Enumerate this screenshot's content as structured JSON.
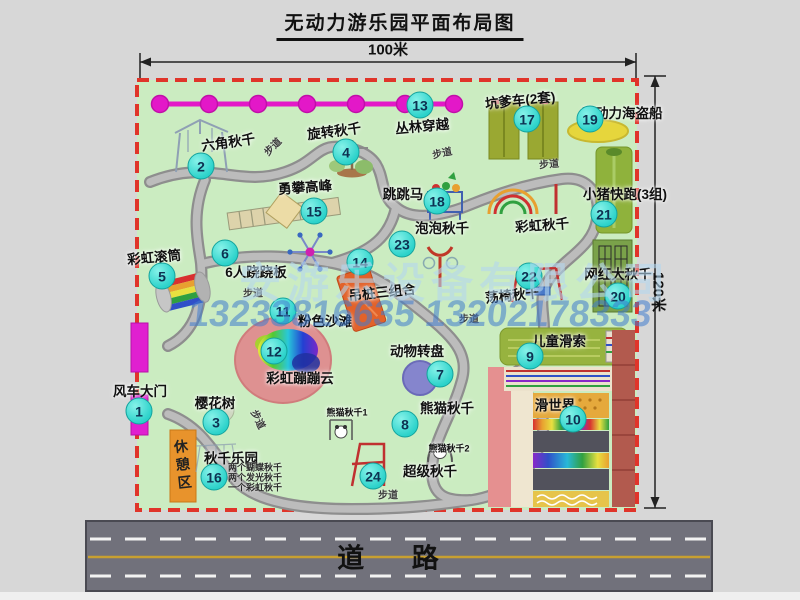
{
  "title": "无动力游乐园平面布局图",
  "dimensions": {
    "width": "100米",
    "height": "120米"
  },
  "road": {
    "label": "道 路"
  },
  "watermark": {
    "company": "安游乐设备有限公司",
    "phones": "13233816635 13202178333"
  },
  "rest_area": {
    "label": "休憩区"
  },
  "colors": {
    "map_green": "#cbecc1",
    "border_red": "#e0342a",
    "badge_cyan": "#2bd2ca",
    "chain_magenta": "#e318c8",
    "gate_magenta": "#e020d0",
    "road_gray": "#71717b",
    "rest_orange": "#e8932c",
    "watermark_blue": "#407cce"
  },
  "map": {
    "walkway_label": "步道",
    "walkway_labels": [
      {
        "x": 272,
        "y": 146,
        "rot": -45
      },
      {
        "x": 442,
        "y": 152,
        "rot": -12
      },
      {
        "x": 549,
        "y": 163,
        "rot": -5
      },
      {
        "x": 253,
        "y": 292,
        "rot": 0
      },
      {
        "x": 469,
        "y": 318,
        "rot": 0
      },
      {
        "x": 259,
        "y": 419,
        "rot": 64
      },
      {
        "x": 388,
        "y": 494,
        "rot": 0
      }
    ],
    "swing_notes": {
      "x": 255,
      "y": 467,
      "items": [
        "两个蝴蝶秋千",
        "两个发光秋千",
        "一个彩虹秋千"
      ]
    },
    "pois": [
      {
        "num": 1,
        "label": "风车大门",
        "lx": 140,
        "ly": 390,
        "bx": 139,
        "by": 411
      },
      {
        "num": 2,
        "label": "六角秋千",
        "lx": 228,
        "ly": 141,
        "rot": -8,
        "bx": 201,
        "by": 166
      },
      {
        "num": 3,
        "label": "樱花树",
        "lx": 215,
        "ly": 402,
        "bx": 216,
        "by": 422
      },
      {
        "num": 4,
        "label": "旋转秋千",
        "lx": 334,
        "ly": 130,
        "rot": -7,
        "bx": 346,
        "by": 152
      },
      {
        "num": 5,
        "label": "彩虹滚筒",
        "lx": 154,
        "ly": 256,
        "rot": -5,
        "bx": 162,
        "by": 276
      },
      {
        "num": 6,
        "label": "6人跷跷板",
        "lx": 256,
        "ly": 271,
        "bx": 225,
        "by": 253
      },
      {
        "num": 7,
        "label": "动物转盘",
        "lx": 417,
        "ly": 350,
        "bx": 440,
        "by": 374
      },
      {
        "num": 8,
        "label": "熊猫秋千",
        "lx": 447,
        "ly": 407,
        "bx": 405,
        "by": 424
      },
      {
        "num": 9,
        "label": "儿童滑索",
        "lx": 559,
        "ly": 340,
        "bx": 530,
        "by": 356
      },
      {
        "num": 10,
        "label": "滑世界",
        "lx": 555,
        "ly": 404,
        "bx": 573,
        "by": 419
      },
      {
        "num": 11,
        "label": "粉色沙滩",
        "lx": 325,
        "ly": 320,
        "bx": 283,
        "by": 311
      },
      {
        "num": 12,
        "label": "彩虹蹦蹦云",
        "lx": 300,
        "ly": 377,
        "bx": 274,
        "by": 351
      },
      {
        "num": 13,
        "label": "丛林穿越",
        "lx": 422,
        "ly": 125,
        "rot": -5,
        "bx": 420,
        "by": 105
      },
      {
        "num": 14,
        "label": "吊桩三组合",
        "lx": 382,
        "ly": 291,
        "rot": -6,
        "bx": 360,
        "by": 262
      },
      {
        "num": 15,
        "label": "勇攀高峰",
        "lx": 305,
        "ly": 186,
        "rot": -4,
        "bx": 314,
        "by": 211
      },
      {
        "num": 16,
        "label": "秋千乐园",
        "lx": 231,
        "ly": 457,
        "bx": 214,
        "by": 477
      },
      {
        "num": 17,
        "label": "坑爹车(2套)",
        "lx": 520,
        "ly": 99,
        "rot": -6,
        "bx": 527,
        "by": 119
      },
      {
        "num": 18,
        "label": "跳跳马",
        "lx": 403,
        "ly": 193,
        "bx": 437,
        "by": 201
      },
      {
        "num": 19,
        "label": "无动力海盗船",
        "lx": 622,
        "ly": 112,
        "bx": 590,
        "by": 119
      },
      {
        "num": 20,
        "label": "网红大秋千",
        "lx": 618,
        "ly": 273,
        "bx": 618,
        "by": 296
      },
      {
        "num": 21,
        "label": "小猪快跑(3组)",
        "lx": 625,
        "ly": 193,
        "bx": 604,
        "by": 214
      },
      {
        "num": 22,
        "label": "荡椅秋千",
        "lx": 512,
        "ly": 294,
        "rot": -6,
        "bx": 529,
        "by": 276
      },
      {
        "num": 23,
        "label": "泡泡秋千",
        "lx": 442,
        "ly": 227,
        "bx": 402,
        "by": 244
      },
      {
        "num": 24,
        "label": "超级秋千",
        "lx": 430,
        "ly": 470,
        "bx": 373,
        "by": 476
      },
      {
        "label": "彩虹秋千",
        "lx": 542,
        "ly": 224,
        "rot": -4
      },
      {
        "label": "熊猫秋千1",
        "lx": 347,
        "ly": 412,
        "small": true
      },
      {
        "label": "熊猫秋千2",
        "lx": 449,
        "ly": 448,
        "small": true
      }
    ]
  }
}
